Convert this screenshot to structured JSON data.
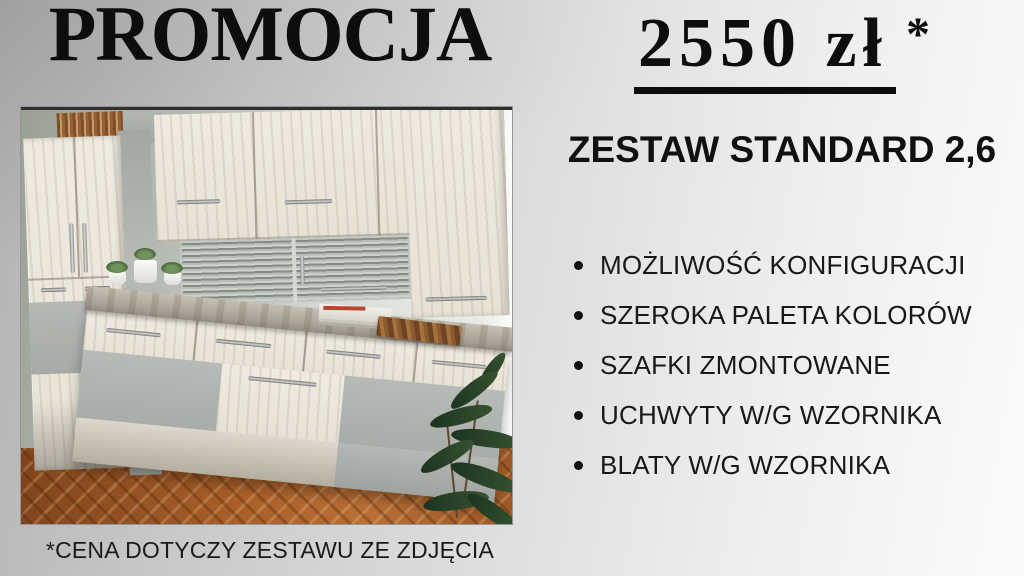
{
  "title": "PROMOCJA",
  "price": {
    "amount": "2550 zł",
    "asterisk": "*"
  },
  "subtitle": "ZESTAW STANDARD 2,6",
  "features": [
    "MOŻLIWOŚĆ KONFIGURACJI",
    "SZEROKA PALETA KOLORÓW",
    "SZAFKI ZMONTOWANE",
    "UCHWYTY W/G WZORNIKA",
    "BLATY W/G WZORNIKA"
  ],
  "footnote": "*CENA DOTYCZY ZESTAWU ZE ZDJĘCIA",
  "colors": {
    "text": "#0d0d0d",
    "background_silver": "#cfcfcf",
    "cabinet_wood": "#e9e4d8",
    "cabinet_gray": "#b2b6b4",
    "countertop_gray": "#a9a296",
    "parquet_brown": "#a25c28",
    "plant_green": "#2c452c"
  }
}
